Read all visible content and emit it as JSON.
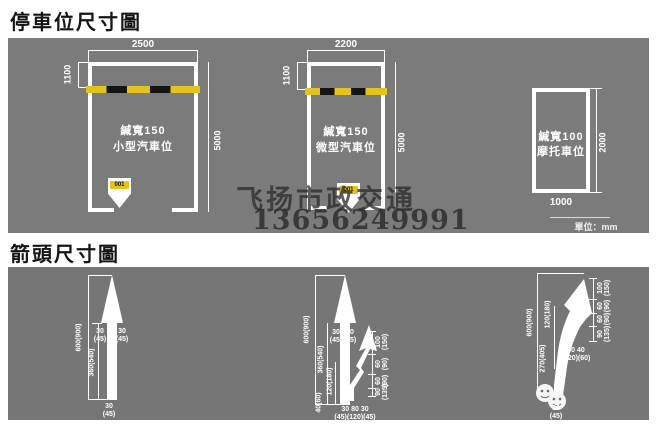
{
  "colors": {
    "panel_gray": "#7b7b7b",
    "panel_gray_dark": "#767676",
    "marking_yellow": "#e3c31d",
    "marking_black": "#141414",
    "line_white": "#ffffff",
    "watermark_gray": "#2e2e2e"
  },
  "watermark": {
    "line1": "飞扬市政交通",
    "line2": "13656249991"
  },
  "parking": {
    "title": "停車位尺寸圖",
    "unit_label": "單位：mm",
    "spaces": [
      {
        "width": "2500",
        "entry_depth": "1100",
        "length": "5000",
        "line_width": "緘寬150",
        "type": "小型汽車位",
        "marker": "001"
      },
      {
        "width": "2200",
        "entry_depth": "1100",
        "length": "5000",
        "line_width": "緘寬150",
        "type": "微型汽車位",
        "marker": "001"
      },
      {
        "width": "1000",
        "length": "2000",
        "line_width": "緘寬100",
        "type": "摩托車位"
      }
    ]
  },
  "arrows": {
    "title": "箭頭尺寸圖",
    "straight": {
      "total": "600(900)",
      "tail": "360(540)",
      "head_left": "30\n(45)",
      "head_right": "30\n(45)",
      "base": "30\n(45)"
    },
    "straight_right": {
      "total": "600(900)",
      "tail": "360(540)",
      "branch": "120(180)",
      "base_offset": "40(60)",
      "head_left": "30\n(45)",
      "head_right": "30\n(45)",
      "base_row": "30 80 30\n(45)(120)(45)",
      "right_segments": [
        "100\n(150)",
        "60\n(90)",
        "60\n(90)",
        "90\n(135)"
      ]
    },
    "right_turn": {
      "total": "600(900)",
      "upper": "120(180)",
      "lower": "270(405)",
      "mid_row": "80 40\n(120)(60)",
      "base": "30\n(45)",
      "right_segments": [
        "100\n(150)",
        "60\n(90)",
        "60\n(90)",
        "90\n(135)"
      ]
    }
  }
}
